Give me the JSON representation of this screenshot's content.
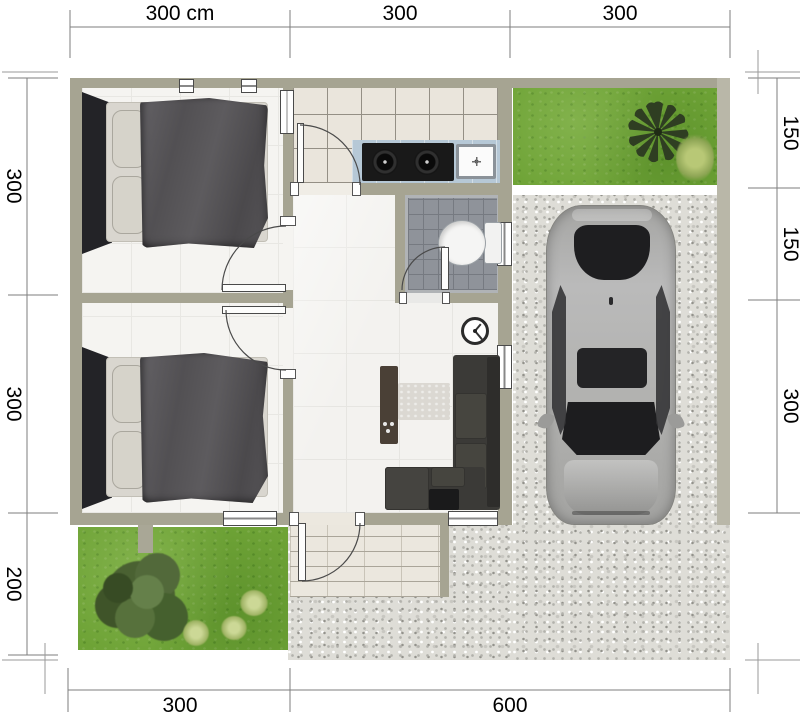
{
  "dimensions": {
    "top": [
      "300 cm",
      "300",
      "300"
    ],
    "left": [
      "300",
      "300",
      "200"
    ],
    "right": [
      "150",
      "150",
      "300"
    ],
    "bottom": [
      "300",
      "600"
    ]
  },
  "colors": {
    "wall": "#a6a492",
    "grass": "#6ea336",
    "gravel": "#deddd7",
    "kitchen_counter": "#b6c8d6",
    "sofa": "#3b3a37",
    "car_body": "#b2b2b0",
    "bathroom_floor": "#8f939a"
  }
}
